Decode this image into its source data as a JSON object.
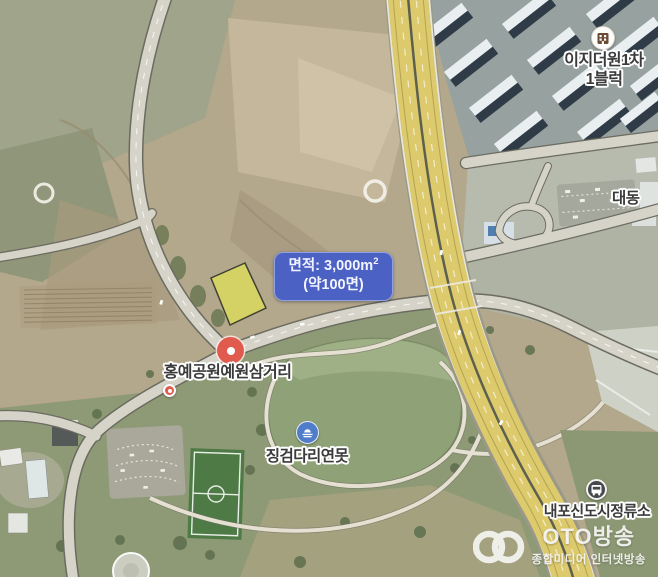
{
  "map": {
    "area_tooltip": {
      "line1_prefix": "면적: 3,000m",
      "line1_sup": "2",
      "line2": "(약100면)"
    },
    "place_labels": {
      "apartment_line1": "이지더원1차",
      "apartment_line2": "1블럭",
      "district": "대동",
      "intersection": "홍예공원예원삼거리",
      "pond": "징검다리연못",
      "bus_stop": "내포신도시정류소"
    },
    "icons": {
      "apartment": "building-icon",
      "pond": "fountain-icon",
      "bus_stop": "bus-icon",
      "intersection": "place-marker-icon"
    },
    "colors": {
      "tooltip_bg": "#4b61c4",
      "parcel_highlight": "#e9ed4e",
      "marker_red": "#e05a4d",
      "pond_icon_blue": "#4f7dc9",
      "highway_yellow": "#dcca6c"
    }
  },
  "watermark": {
    "brand": "OTO방송",
    "subtitle": "종합미디어 인터넷방송"
  }
}
